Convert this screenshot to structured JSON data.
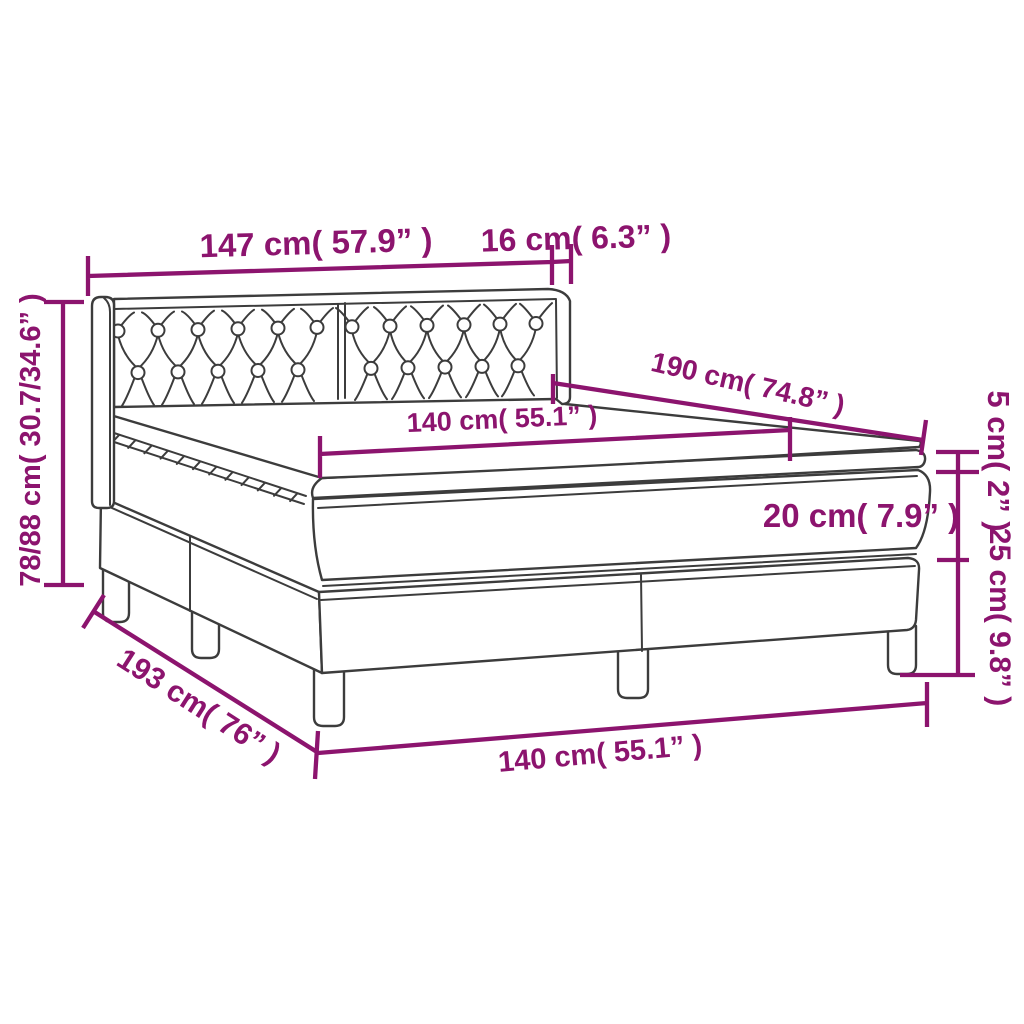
{
  "diagram": {
    "type": "product-dimension-diagram",
    "subject": "box-spring-bed-with-tufted-headboard-and-topper",
    "colors": {
      "accent": "#8c146e",
      "line_art": "#3c3c3c",
      "background": "#ffffff"
    },
    "labels": {
      "headboard_width": "147 cm( 57.9” )",
      "headboard_depth": "16 cm( 6.3” )",
      "bed_length": "190 cm( 74.8” )",
      "mattress_width": "140 cm( 55.1” )",
      "topper_height": "5 cm( 2” )",
      "mattress_height": "20 cm( 7.9” )",
      "base_height": "25 cm( 9.8” )",
      "total_height": "78/88 cm( 30.7/34.6” )",
      "base_length": "193 cm( 76” )",
      "base_width": "140 cm( 55.1” )"
    }
  }
}
